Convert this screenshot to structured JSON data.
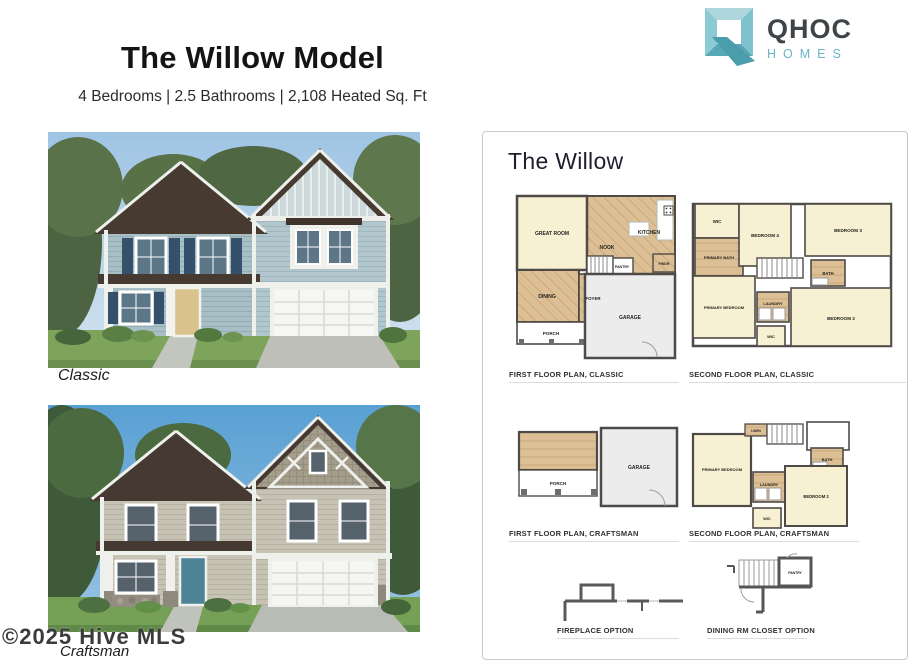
{
  "header": {
    "title": "The Willow Model",
    "subtitle": "4 Bedrooms | 2.5 Bathrooms | 2,108 Heated Sq. Ft"
  },
  "logo": {
    "name": "QHOC",
    "tagline": "HOMES"
  },
  "colors": {
    "brand_teal": "#5fb0bf",
    "logo_text": "#3e4447",
    "plan_wood": "#d9bd92",
    "plan_cream": "#f7f0d2",
    "plan_gray": "#ececec",
    "plan_wall": "#4e4a47"
  },
  "photos": {
    "classic_label": "Classic",
    "craftsman_label": "Craftsman"
  },
  "watermark": "©2025 Hive MLS",
  "panel": {
    "heading": "The Willow",
    "plans": {
      "first_classic": {
        "caption": "FIRST FLOOR PLAN, CLASSIC",
        "rooms": {
          "great_room": "GREAT ROOM",
          "nook": "NOOK",
          "kitchen": "KITCHEN",
          "pantry": "PANTRY",
          "pwdr": "PWDR",
          "dining": "DINING",
          "foyer": "FOYER",
          "porch": "PORCH",
          "garage": "GARAGE"
        }
      },
      "second_classic": {
        "caption": "SECOND FLOOR PLAN, CLASSIC",
        "rooms": {
          "wic": "WIC",
          "primary_bath": "PRIMARY BATH",
          "bedroom4": "BEDROOM 4",
          "bedroom3": "BEDROOM 3",
          "primary_bedroom": "PRIMARY BEDROOM",
          "bath": "BATH",
          "laundry": "LAUNDRY",
          "bedroom2": "BEDROOM 2",
          "wic2": "WIC"
        }
      },
      "first_craftsman": {
        "caption": "FIRST FLOOR PLAN, CRAFTSMAN",
        "rooms": {
          "porch": "PORCH",
          "garage": "GARAGE"
        }
      },
      "second_craftsman": {
        "caption": "SECOND FLOOR PLAN, CRAFTSMAN",
        "rooms": {
          "primary_bedroom": "PRIMARY BEDROOM",
          "linen": "LINEN",
          "bath": "BATH",
          "laundry": "LAUNDRY",
          "bedroom2": "BEDROOM 2",
          "wic": "WIC"
        }
      },
      "fireplace_option": {
        "caption": "FIREPLACE OPTION"
      },
      "dining_closet_option": {
        "caption": "DINING RM CLOSET OPTION",
        "closet_label": "PANTRY"
      }
    }
  }
}
